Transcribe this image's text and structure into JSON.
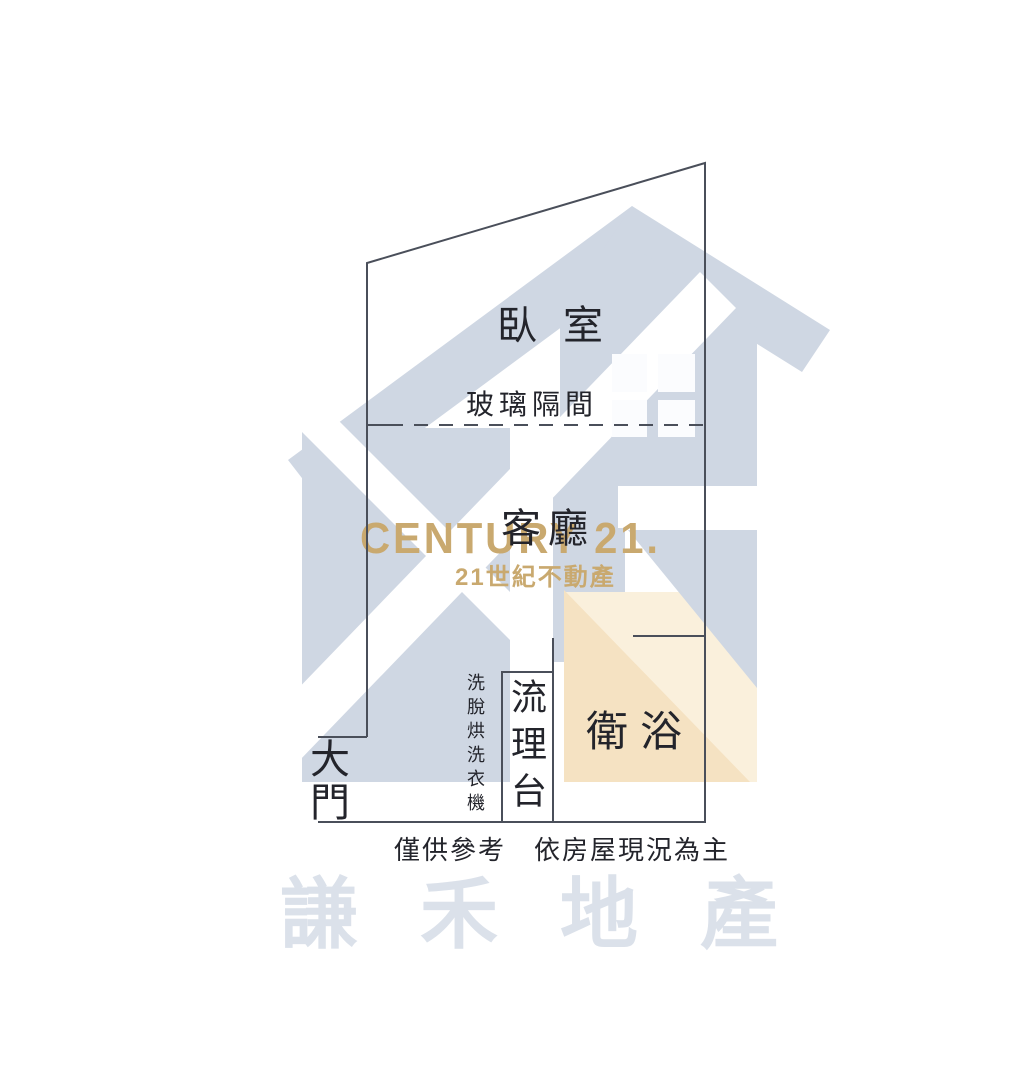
{
  "branding": {
    "wordmark": "CENTURY 21.",
    "wordmark_sub": "21世紀不動產",
    "agency_watermark": "謙禾地產"
  },
  "floorplan": {
    "labels": {
      "bedroom": "臥室",
      "glass_partition": "玻璃隔間",
      "living_room": "客廳",
      "bathroom": "衛浴",
      "sink_counter": "流理台",
      "washer_dryer": "洗脫烘洗衣機",
      "main_door": "大門"
    },
    "disclaimer": "僅供參考　依房屋現況為主"
  },
  "colors": {
    "watermark_blue": "#cfd7e3",
    "watermark_blue_light": "#dbe1ea",
    "beige": "#f5e2c2",
    "beige_light": "#faf0dc",
    "gold": "#c9a96f",
    "wall_line": "#4a4f5a",
    "ink": "#23242b",
    "background": "#ffffff"
  }
}
